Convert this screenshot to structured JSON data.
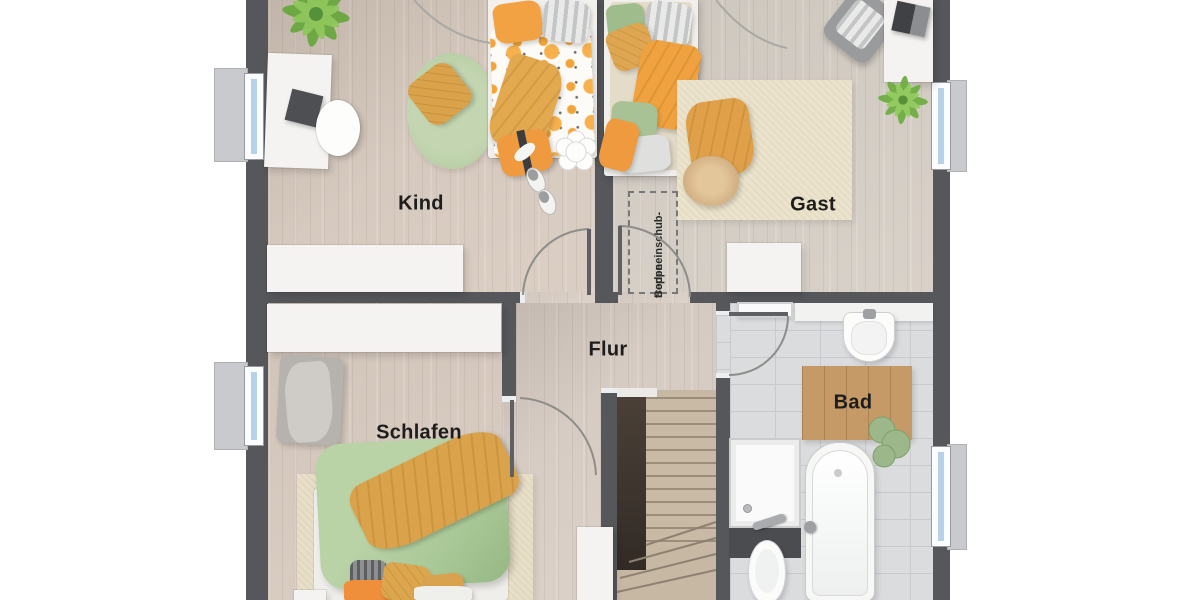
{
  "plan": {
    "type": "floor-plan-top-view",
    "rooms": {
      "kind": {
        "label": "Kind",
        "furniture": [
          "bed",
          "desk",
          "desk-chair",
          "round-rug",
          "floor-pillow",
          "sideboard",
          "plant",
          "slippers",
          "flower-side-table"
        ]
      },
      "gast": {
        "label": "Gast",
        "furniture": [
          "bed",
          "rug",
          "blanket",
          "pouf",
          "armchair",
          "desk",
          "laptop",
          "plant",
          "wardrobe"
        ]
      },
      "flur": {
        "label": "Flur",
        "furniture": [
          "staircase",
          "cabinet"
        ]
      },
      "schlafen": {
        "label": "Schlafen",
        "furniture": [
          "bed",
          "rug",
          "wardrobe",
          "chair-with-clothes",
          "nightstand"
        ]
      },
      "bad": {
        "label": "Bad",
        "furniture": [
          "sink",
          "shower",
          "bathtub",
          "toilet",
          "towel-radiator",
          "wooden-bath-mat",
          "towel"
        ]
      }
    },
    "annotations": {
      "attic_stairs": {
        "line1": "Bodeneinschub-",
        "line2": "treppe"
      }
    },
    "colors": {
      "wall": "#56575b",
      "wood_floor": "#d9ccc1",
      "bath_tile": "#dadcde",
      "rug_beige": "#ebe3cc",
      "accent_orange": "#ef9a3e",
      "accent_mustard": "#d9a24b",
      "accent_sage": "#a9c897",
      "window_glass": "#b7d2e6",
      "bath_mat_wood": "#c69a66"
    }
  }
}
